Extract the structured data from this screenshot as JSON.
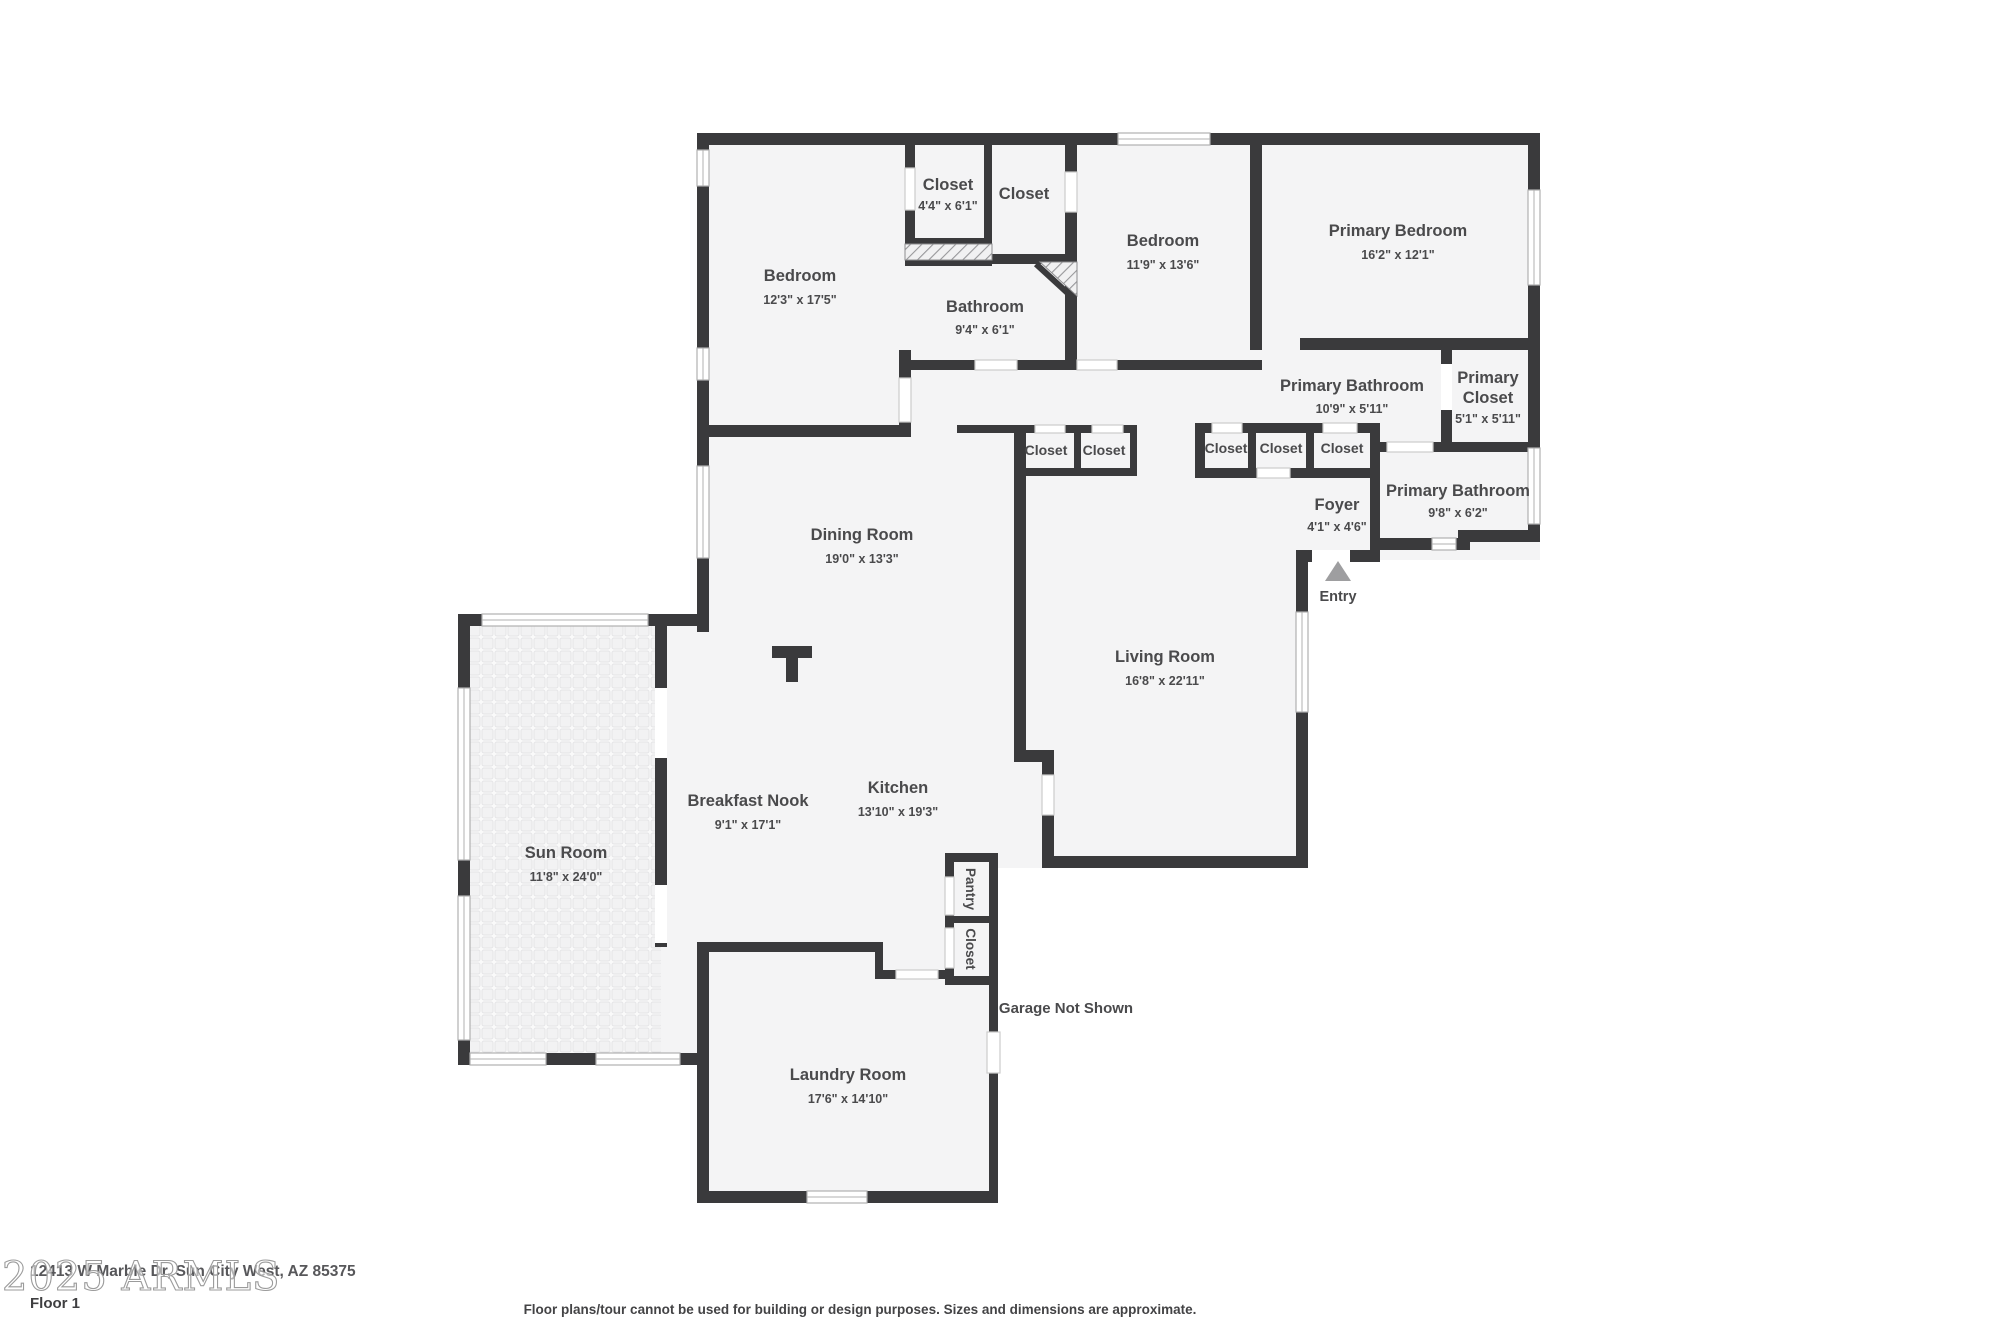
{
  "plan": {
    "colors": {
      "wall": "#3a3a3c",
      "floor": "#f4f4f5",
      "label": "#4a4a4c",
      "opening_stroke": "#cccccc",
      "window_stroke": "#b0b0b0",
      "entry_arrow": "#9e9ea0",
      "watermark": "#9b9b9b",
      "tile_line": "#e4e4e6"
    },
    "rooms": [
      {
        "name": "Bedroom",
        "dims": "12'3\" x 17'5\""
      },
      {
        "name": "Closet",
        "dims": "4'4\" x 6'1\""
      },
      {
        "name": "Closet",
        "dims": ""
      },
      {
        "name": "Bathroom",
        "dims": "9'4\" x 6'1\""
      },
      {
        "name": "Bedroom",
        "dims": "11'9\" x 13'6\""
      },
      {
        "name": "Primary Bedroom",
        "dims": "16'2\" x 12'1\""
      },
      {
        "name": "Primary Bathroom",
        "dims": "10'9\" x 5'11\""
      },
      {
        "name": "Primary Closet",
        "name_line1": "Primary",
        "name_line2": "Closet",
        "dims": "5'1\" x 5'11\""
      },
      {
        "name": "Closet"
      },
      {
        "name": "Closet"
      },
      {
        "name": "Closet"
      },
      {
        "name": "Closet"
      },
      {
        "name": "Closet"
      },
      {
        "name": "Foyer",
        "dims": "4'1\" x 4'6\""
      },
      {
        "name": "Primary Bathroom",
        "dims": "9'8\" x 6'2\""
      },
      {
        "name": "Entry"
      },
      {
        "name": "Dining Room",
        "dims": "19'0\" x 13'3\""
      },
      {
        "name": "Living Room",
        "dims": "16'8\" x 22'11\""
      },
      {
        "name": "Kitchen",
        "dims": "13'10\" x 19'3\""
      },
      {
        "name": "Breakfast Nook",
        "dims": "9'1\" x 17'1\""
      },
      {
        "name": "Sun Room",
        "dims": "11'8\" x 24'0\""
      },
      {
        "name": "Pantry"
      },
      {
        "name": "Closet"
      },
      {
        "name": "Garage Not Shown"
      },
      {
        "name": "Laundry Room",
        "dims": "17'6\" x 14'10\""
      }
    ]
  },
  "footer": {
    "watermark": "2025 ARMLS",
    "address": "12413 W Marble Dr, Sun City West, AZ 85375",
    "floor_label": "Floor 1",
    "disclaimer": "Floor plans/tour cannot be used for building or design purposes. Sizes and dimensions are approximate."
  }
}
